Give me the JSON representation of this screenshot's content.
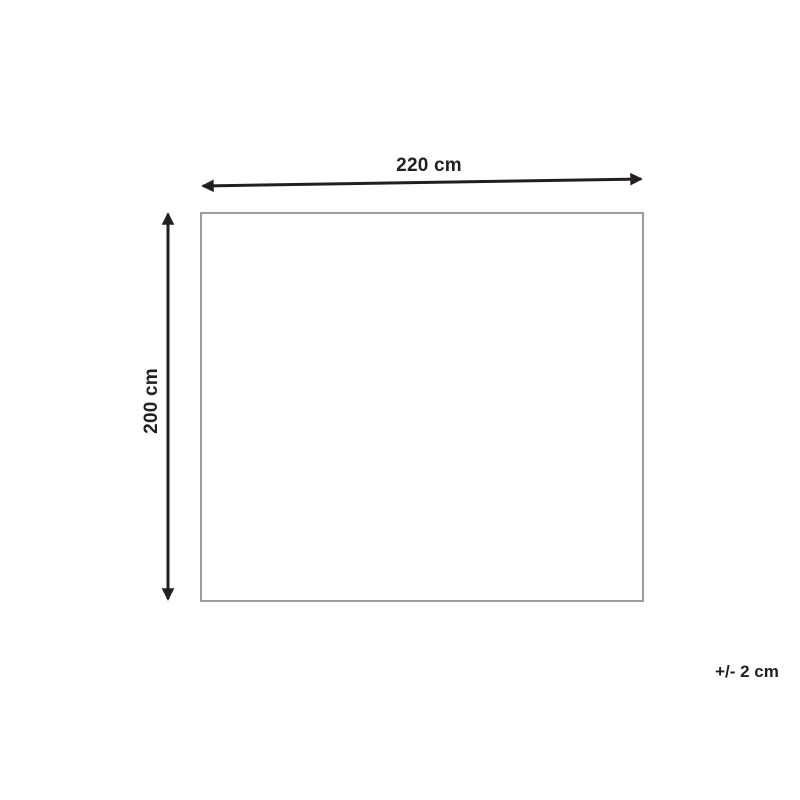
{
  "diagram": {
    "type": "product-dimension-diagram",
    "width_label": "220 cm",
    "height_label": "200 cm",
    "tolerance_label": "+/- 2 cm",
    "colors": {
      "background": "#ffffff",
      "arrow": "#231f20",
      "label_text": "#231f20",
      "rectangle_border": "#9b9b9b"
    }
  }
}
